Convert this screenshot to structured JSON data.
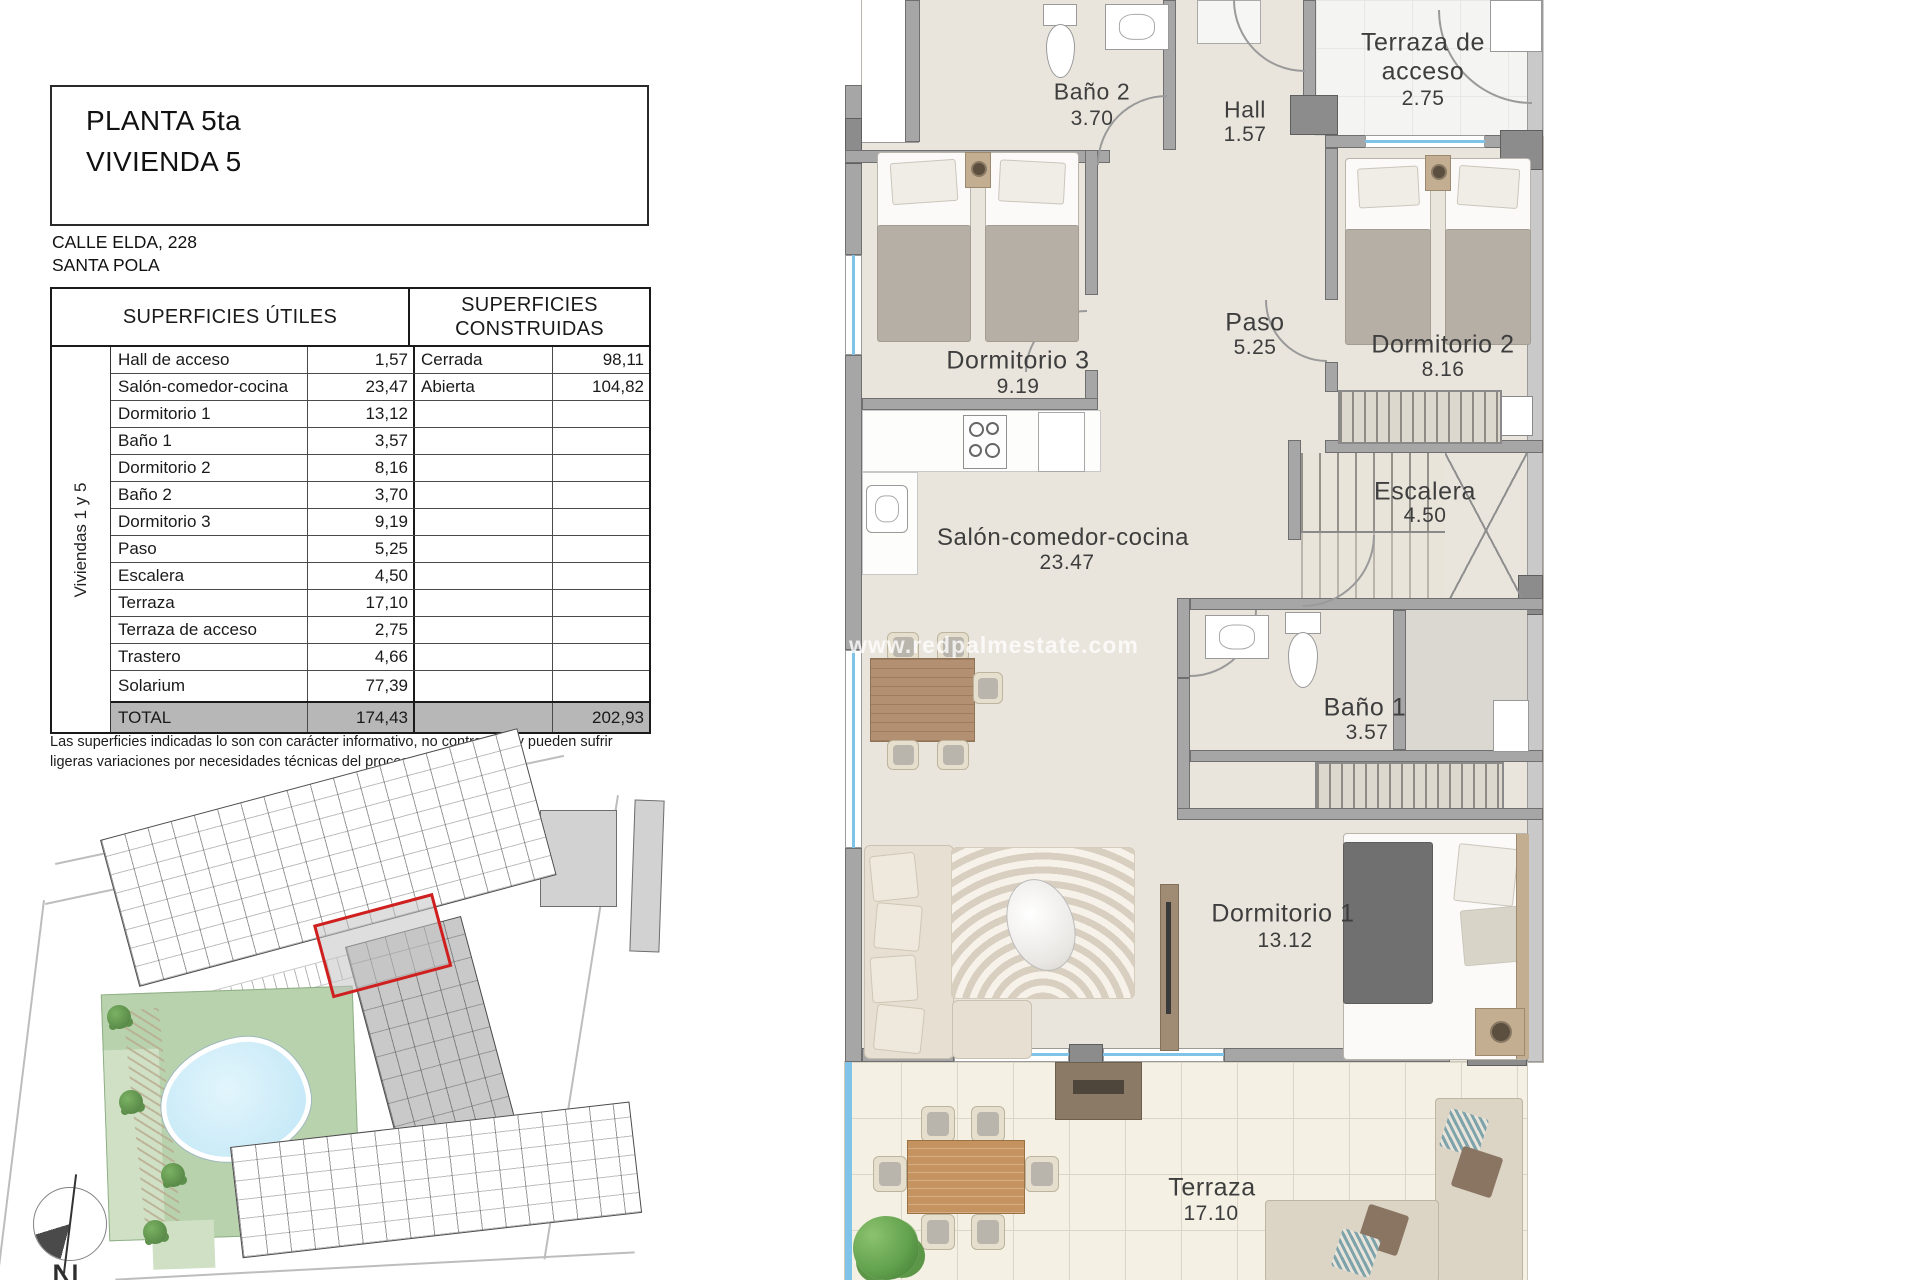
{
  "header": {
    "title_line1": "PLANTA 5ta",
    "title_line2": "VIVIENDA 5",
    "address_line1": "CALLE ELDA, 228",
    "address_line2": "SANTA POLA"
  },
  "table": {
    "col_utiles_header": "SUPERFICIES ÚTILES",
    "col_construidas_header": "SUPERFICIES CONSTRUIDAS",
    "group_label": "Viviendas 1 y 5",
    "rows": [
      {
        "name": "Hall de acceso",
        "value": "1,57",
        "c_name": "Cerrada",
        "c_value": "98,11"
      },
      {
        "name": "Salón-comedor-cocina",
        "value": "23,47",
        "c_name": "Abierta",
        "c_value": "104,82"
      },
      {
        "name": "Dormitorio 1",
        "value": "13,12",
        "c_name": "",
        "c_value": ""
      },
      {
        "name": "Baño 1",
        "value": "3,57",
        "c_name": "",
        "c_value": ""
      },
      {
        "name": "Dormitorio 2",
        "value": "8,16",
        "c_name": "",
        "c_value": ""
      },
      {
        "name": "Baño 2",
        "value": "3,70",
        "c_name": "",
        "c_value": ""
      },
      {
        "name": "Dormitorio 3",
        "value": "9,19",
        "c_name": "",
        "c_value": ""
      },
      {
        "name": "Paso",
        "value": "5,25",
        "c_name": "",
        "c_value": ""
      },
      {
        "name": "Escalera",
        "value": "4,50",
        "c_name": "",
        "c_value": ""
      },
      {
        "name": "Terraza",
        "value": "17,10",
        "c_name": "",
        "c_value": ""
      },
      {
        "name": "Terraza de acceso",
        "value": "2,75",
        "c_name": "",
        "c_value": ""
      },
      {
        "name": "Trastero",
        "value": "4,66",
        "c_name": "",
        "c_value": ""
      },
      {
        "name": "Solarium",
        "value": "77,39",
        "c_name": "",
        "c_value": ""
      }
    ],
    "total": {
      "label": "TOTAL",
      "utiles": "174,43",
      "construidas": "202,93"
    }
  },
  "disclaimer": "Las superficies indicadas lo son con carácter informativo, no contractual y pueden sufrir ligeras variaciones por necesidades técnicas del proceso de construcción.",
  "floorplan": {
    "watermark": "www.redpalmestate.com",
    "rooms": [
      {
        "name": "Baño 2",
        "area": "3.70"
      },
      {
        "name": "Hall",
        "area": "1.57"
      },
      {
        "name": "Terraza de acceso",
        "area": "2.75"
      },
      {
        "name": "Dormitorio 3",
        "area": "9.19"
      },
      {
        "name": "Paso",
        "area": "5.25"
      },
      {
        "name": "Dormitorio 2",
        "area": "8.16"
      },
      {
        "name": "Escalera",
        "area": "4.50"
      },
      {
        "name": "Salón-comedor-cocina",
        "area": "23.47"
      },
      {
        "name": "Baño 1",
        "area": "3.57"
      },
      {
        "name": "Dormitorio 1",
        "area": "13.12"
      },
      {
        "name": "Terraza",
        "area": "17.10"
      }
    ]
  },
  "siteplan": {
    "north_label": "N"
  }
}
